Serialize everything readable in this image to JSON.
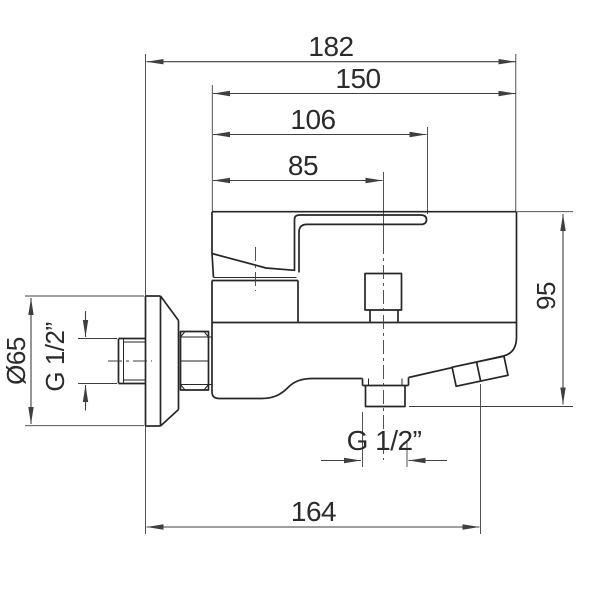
{
  "drawing": {
    "type": "technical-dimension-drawing",
    "subject": "Wall-mounted single-lever bath/shower mixer tap, side view with dimensions",
    "units": "mm",
    "colors": {
      "background": "#ffffff",
      "object_line": "#262626",
      "dimension_line": "#3f3f3f",
      "text": "#2b2b2b"
    },
    "dimensions": {
      "overall_depth": "182",
      "body_width": "150",
      "handle_length": "106",
      "outlet_center_offset": "85",
      "body_height": "95",
      "escutcheon_diameter": "Ø65",
      "inlet_thread": "G 1/2”",
      "outlet_thread": "G 1/2”",
      "spout_reach": "164"
    }
  }
}
